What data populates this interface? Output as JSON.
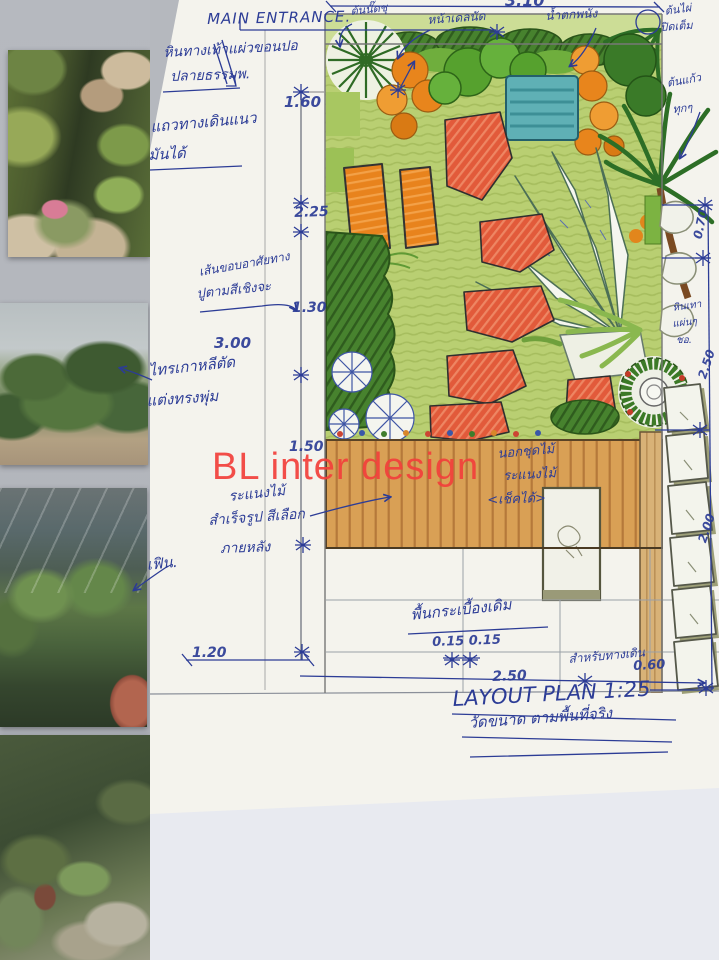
{
  "watermark": {
    "text": "BL inter design",
    "color": "#f2413c"
  },
  "plan": {
    "entrance_label": "MAIN ENTRANCE.",
    "title": "LAYOUT PLAN 1:25",
    "subtitle": "วัดขนาด ตามพื้นที่จริง",
    "dims": {
      "top": "3.10",
      "l160": "1.60",
      "l225": "2.25",
      "l130": "1.30",
      "l300": "3.00",
      "l150": "1.50",
      "r070": "0.70",
      "r250": "2.50",
      "r200": "2.00",
      "b120": "1.20",
      "b015": "0.15 0.15",
      "b250": "2.50",
      "b060": "0.60"
    },
    "notes": {
      "walk1": "หินทางเท้าแผ่วขอนปอ",
      "walk2": "ปลายธรรมพ.",
      "row1": "แถวทางเดินแนว",
      "row2": "มันได้",
      "edge1": "เส้นขอบอาศัยทาง",
      "edge2": "ปูตามสีเชิงจะ",
      "ficus1": "ไทรเกาหลีตัด",
      "ficus2": "แต่งทรงพุ่ม",
      "lattice1": "ระแนงไม้",
      "lattice2": "สำเร็จรูป สีเลือก",
      "lattice3": "ภายหลัง",
      "fern": "เฟิน.",
      "deck1": "นอกชุดไม้",
      "deck2": "ระแนงไม้",
      "deck3": "<เช็คได้>",
      "tile": "พื้นกระเบื้องเดิม",
      "forpath": "สำหรับทางเดิน",
      "tree1": "ต้นนั๊ดชุ",
      "tree2": "หน้าเดลนัด",
      "waterfall": "น้ำตกพนัง",
      "bamboo1": "ต้นไผ่",
      "bamboo2": "ปิดเต็ม",
      "kaew1": "ต้นแก้ว",
      "kaew2": "ทุกๆ",
      "grey1": "หินเทา",
      "grey2": "แผ่นๆ",
      "grey3": "ชอ."
    }
  },
  "photos": [
    {
      "id": "photo-waterfall-rocks"
    },
    {
      "id": "photo-topiary-nursery"
    },
    {
      "id": "photo-greenhouse-ferns"
    },
    {
      "id": "photo-garden-path"
    },
    {
      "id": "photo-monstera"
    }
  ],
  "colors": {
    "ink": "#2c3c96",
    "lawn": "#b9cf72",
    "deck": "#d9a055",
    "pond": "#5fb0b5",
    "stone": "#e2593b"
  }
}
